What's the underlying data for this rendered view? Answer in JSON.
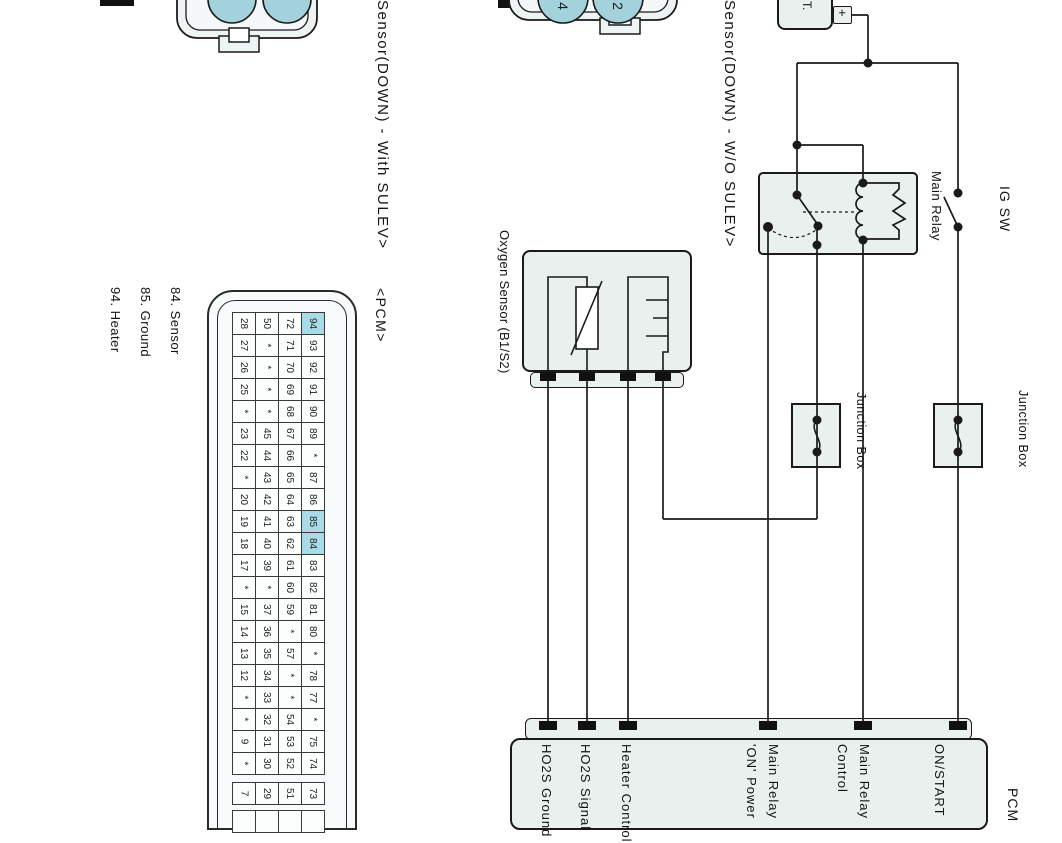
{
  "colors": {
    "box_fill": "#e9f0ee",
    "connector_pin_fill": "#a3d2dd",
    "pin_highlight": "#a9dbe7",
    "wire": "#1a1a1a",
    "terminal": "#111111"
  },
  "diagram": {
    "note_with_sulev": "Sensor(DOWN) - With SULEV>",
    "note_wo_sulev": "Sensor(DOWN) - W/O SULEV>",
    "battery_label": "T.",
    "battery_plus": "+",
    "ig_switch": "IG SW",
    "main_relay": "Main Relay",
    "oxygen_sensor": "Oxygen Sensor (B1/S2)",
    "junction_box_1": "Junction Box",
    "junction_box_2": "Junction Box",
    "pcm_connector_tag": "<PCM>",
    "pcm_name": "PCM",
    "connector2_pin_left": "4",
    "connector2_pin_right": "2",
    "legend": [
      "84. Sensor",
      "85. Ground",
      "94. Heater"
    ],
    "pcm_terminal_labels": [
      [
        "HO2S Ground"
      ],
      [
        "HO2S Signal"
      ],
      [
        "Heater Control"
      ],
      [
        "Main Relay",
        "'ON' Power"
      ],
      [
        "Main Relay",
        "Control"
      ],
      [
        "ON/START"
      ]
    ]
  },
  "pin_grid": {
    "highlighted": [
      "94",
      "85",
      "84"
    ],
    "rows": [
      [
        "28",
        "50",
        "72",
        "94"
      ],
      [
        "27",
        "*",
        "71",
        "93"
      ],
      [
        "26",
        "*",
        "70",
        "92"
      ],
      [
        "25",
        "*",
        "69",
        "91"
      ],
      [
        "*",
        "*",
        "68",
        "90"
      ],
      [
        "23",
        "45",
        "67",
        "89"
      ],
      [
        "22",
        "44",
        "66",
        "*"
      ],
      [
        "*",
        "43",
        "65",
        "87"
      ],
      [
        "20",
        "42",
        "64",
        "86"
      ],
      [
        "19",
        "41",
        "63",
        "85"
      ],
      [
        "18",
        "40",
        "62",
        "84"
      ],
      [
        "17",
        "39",
        "61",
        "83"
      ],
      [
        "*",
        "*",
        "60",
        "82"
      ],
      [
        "15",
        "37",
        "59",
        "81"
      ],
      [
        "14",
        "36",
        "*",
        "80"
      ],
      [
        "13",
        "35",
        "57",
        "*"
      ],
      [
        "12",
        "34",
        "*",
        "78"
      ],
      [
        "*",
        "33",
        "*",
        "77"
      ],
      [
        "*",
        "32",
        "54",
        "*"
      ],
      [
        "9",
        "31",
        "53",
        "75"
      ],
      [
        "*",
        "30",
        "52",
        "74"
      ],
      [
        "7",
        "29",
        "51",
        "73"
      ],
      [
        "",
        "",
        "",
        ""
      ]
    ]
  }
}
